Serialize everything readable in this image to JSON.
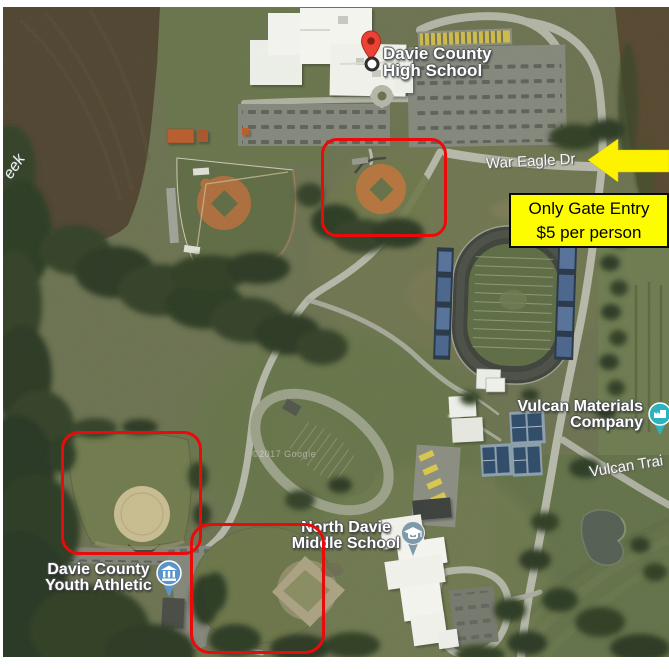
{
  "page": {
    "background": "#ffffff"
  },
  "colors": {
    "highlight_box": "#ea0a0a",
    "arrow_fill": "#fdf300",
    "notice_bg": "#fdfd00",
    "notice_border": "#000000",
    "notice_text": "#000000",
    "destination_pin": "#ea4335",
    "school_pin": "#7e99a8",
    "civic_pin": "#5b94c8",
    "business_pin": "#2db3c0"
  },
  "places": {
    "high_school": {
      "line1": "Davie County",
      "line2": "High School"
    },
    "middle_school": {
      "line1": "North Davie",
      "line2": "Middle School"
    },
    "youth_athletic": {
      "line1": "Davie County",
      "line2": "Youth Athletic"
    },
    "vulcan_materials": {
      "line1": "Vulcan Materials",
      "line2": "Company"
    }
  },
  "roads": {
    "war_eagle_dr": "War Eagle Dr",
    "vulcan_trail_partial": "Vulcan Trai"
  },
  "water": {
    "creek_label_partial": "eek"
  },
  "watermark": "©2017 Google",
  "annotations": {
    "gate_notice": {
      "line1": "Only Gate Entry",
      "line2": "$5 per person"
    },
    "arrow_direction": "left",
    "highlighted_fields_count": 3
  }
}
